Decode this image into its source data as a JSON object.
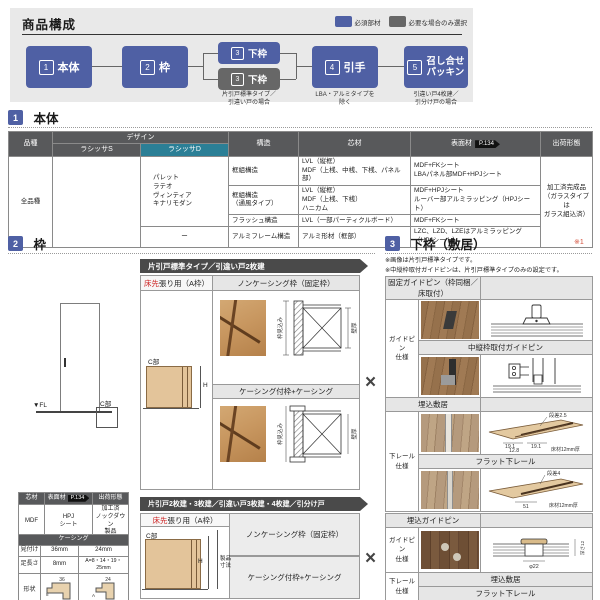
{
  "colors": {
    "accent_blue": "#4f60a4",
    "accent_gray": "#676767",
    "teal": "#2b7f96",
    "table_header": "#58595b",
    "red": "#cc1f1f",
    "panel_bg": "#e9e9e9"
  },
  "header": {
    "title": "商品構成",
    "legend": {
      "required": "必須部材",
      "optional": "必要な場合のみ選択"
    },
    "flow": [
      {
        "num": "1",
        "label": "本体",
        "caption": ""
      },
      {
        "num": "2",
        "label": "枠",
        "caption": ""
      },
      {
        "num": "3",
        "label": "下枠",
        "caption": ""
      },
      {
        "num": "3",
        "label": "下枠",
        "caption": "片引戸標準タイプ／\n引違い戸の場合"
      },
      {
        "num": "4",
        "label": "引手",
        "caption": "LBA・アルミタイプを\n除く"
      },
      {
        "num": "5",
        "label": "召し合せ\nパッキン",
        "caption": "引違い戸4枚建／\n引分け戸の場合"
      }
    ]
  },
  "section1": {
    "num": "1",
    "title": "本体",
    "table": {
      "h_hinshu": "品種",
      "h_design": "デザイン",
      "h_s": "ラシッサS",
      "h_d": "ラシッサD",
      "h_kozo": "構造",
      "h_shinzai": "芯材",
      "h_hyomen": "表面材",
      "badge": "P.134",
      "h_shukka": "出荷形態",
      "hinshu": "全品種",
      "design_d": "パレット\nラテオ\nヴィンティア\nキナリモダン",
      "design_d_last": "ー",
      "rows": [
        {
          "kozo": "框組構造",
          "shinzai": "LVL（縦框）\nMDF（上桟、中桟、下桟、パネル部）",
          "hyomen": "MDF+FKシート\nLBAパネル部MDF+HPJシート"
        },
        {
          "kozo": "框組構造\n（通風タイプ）",
          "shinzai": "LVL（縦框）\nMDF（上桟、下桟）\nハニカム",
          "hyomen": "MDF+HPJシート\nルーバー部アルミラッピング（HPJシート）"
        },
        {
          "kozo": "フラッシュ構造",
          "shinzai": "LVL（一部パーティクルボード）",
          "hyomen": "MDF+FKシート"
        },
        {
          "kozo": "アルミフレーム構造",
          "shinzai": "アルミ形材（框部）",
          "hyomen": "LZC、LZD、LZEはアルミラッピング（HPJシート）"
        }
      ],
      "shukka": "加工済完成品\n（ガラスタイプは\nガラス組込済）"
    }
  },
  "section2": {
    "num": "2",
    "title": "枠",
    "cross_mark": "×",
    "elevation": {
      "fl": "▼FL",
      "c_label": "C部"
    },
    "spec_table": {
      "h_core": "芯材",
      "h_surface": "表面材",
      "badge": "P.134",
      "h_ship": "出荷形態",
      "core": "MDF",
      "surface": "HPJ\nシート",
      "ship": "加工済\nノックダウン\n製品"
    },
    "casing_table": {
      "title": "ケーシング",
      "r1": "見付け",
      "r1a": "36mm",
      "r1b": "24mm",
      "r2": "足長さ",
      "r2a": "8mm",
      "r2b": "A=8・14・19・25mm",
      "r3": "形状",
      "d36": "36",
      "d8": "8",
      "d24": "24",
      "dA": "A"
    },
    "block1": {
      "banner": "片引戸標準タイプ／引違い戸2枚建",
      "left_red": "床先",
      "left_rest": "張り用（A枠）",
      "c_label": "C部",
      "h_label": "H",
      "row1": "ノンケーシング枠（固定枠）",
      "row2": "ケーシング付枠+ケーシング",
      "dim_left": "枠見込み",
      "dim_right": "壁厚"
    },
    "block2": {
      "banner": "片引戸2枚建・3枚建／引違い戸3枚建・4枚建／引分け戸",
      "left_red": "床先",
      "left_rest": "張り用（A枠）",
      "c_label": "C部",
      "h_label": "H",
      "dim_label": "製品\n寸法",
      "row1": "ノンケーシング枠（固定枠）",
      "row2": "ケーシング付枠+ケーシング"
    }
  },
  "section3": {
    "num": "3",
    "title": "下枠（敷居）",
    "note_ref": "※1",
    "notes": [
      "※画像は片引戸標準タイプです。",
      "※中縦枠取付ガイドピンは、片引戸標準タイプのみの設定です。"
    ],
    "table1": {
      "row_label1": "ガイドピン\n仕様",
      "row_label2": "下レール\n仕様",
      "h1": "固定ガイドピン（枠同梱／床取付）",
      "h2": "中縦枠取付ガイドピン",
      "h3": "埋込敷居",
      "h4": "フラット下レール",
      "dims3": {
        "step": "段差2.5",
        "a": "19.1",
        "b": "19.1",
        "c": "12.8",
        "floor": "床材12mm厚"
      },
      "dims4": {
        "step": "段差4",
        "a": "51",
        "floor": "床材12mm厚"
      }
    },
    "table2": {
      "row_label1": "ガイドピン\n仕様",
      "row_label2": "下レール\n仕様",
      "h1": "埋込ガイドピン",
      "h2": "埋込敷居",
      "h3": "フラット下レール",
      "dims": {
        "dia": "φ22",
        "depth": "深さ12"
      }
    }
  }
}
